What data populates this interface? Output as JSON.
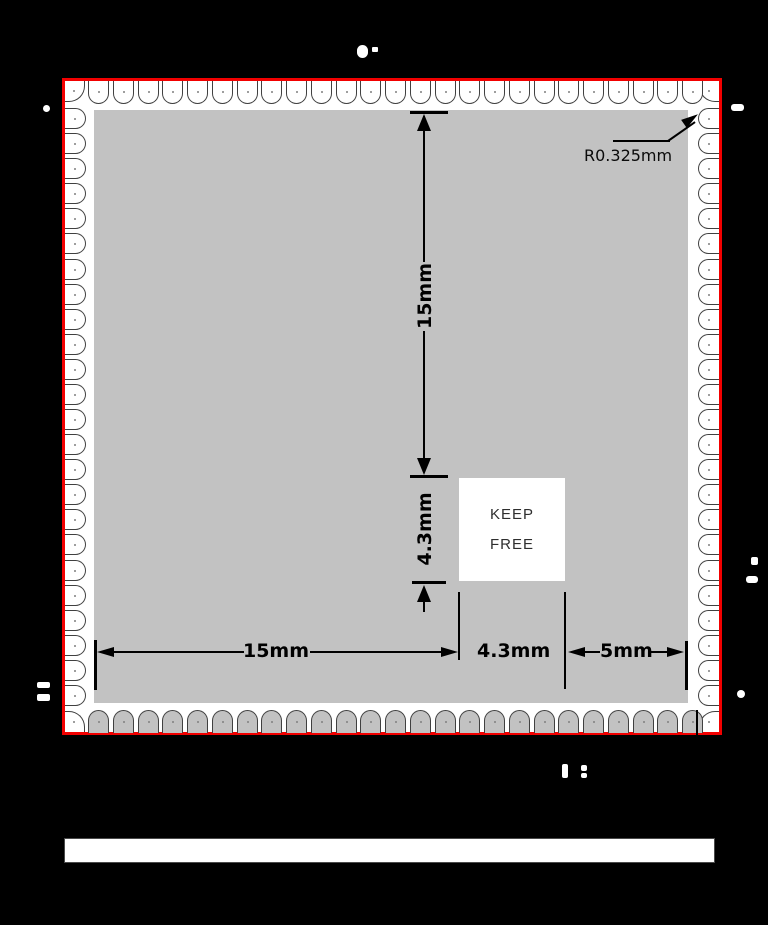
{
  "annotations": {
    "vertical_15mm": "15mm",
    "vertical_4_3mm": "4.3mm",
    "horizontal_15mm": "15mm",
    "horizontal_4_3mm": "4.3mm",
    "horizontal_5mm": "5mm",
    "pad_radius": "R0.325mm",
    "keep_free": {
      "line1": "KEEP",
      "line2": "FREE"
    }
  },
  "colors": {
    "background": "#000000",
    "board_outline": "#f20000",
    "board_fill": "#ffffff",
    "module_fill": "#c2c2c2",
    "pad_outline": "#404040",
    "dimension_lines": "#000000"
  },
  "pads": {
    "top": {
      "count": 25,
      "from": 88,
      "to": 703,
      "size": 21
    },
    "bottom": {
      "count": 25,
      "from": 88,
      "to": 703,
      "size": 21
    },
    "left": {
      "count": 24,
      "from": 108,
      "to": 706,
      "size": 21
    },
    "right": {
      "count": 24,
      "from": 108,
      "to": 706,
      "size": 21
    }
  },
  "artifacts": [
    {
      "x": 357,
      "y": 45,
      "w": 11,
      "h": 13,
      "r": 6
    },
    {
      "x": 372,
      "y": 47,
      "w": 6,
      "h": 5,
      "r": 1
    },
    {
      "x": 43,
      "y": 105,
      "w": 7,
      "h": 7,
      "r": 4
    },
    {
      "x": 731,
      "y": 104,
      "w": 13,
      "h": 7,
      "r": 3
    },
    {
      "x": 751,
      "y": 557,
      "w": 7,
      "h": 8,
      "r": 2
    },
    {
      "x": 746,
      "y": 576,
      "w": 12,
      "h": 7,
      "r": 3
    },
    {
      "x": 737,
      "y": 690,
      "w": 8,
      "h": 8,
      "r": 4
    },
    {
      "x": 37,
      "y": 682,
      "w": 13,
      "h": 6,
      "r": 2
    },
    {
      "x": 37,
      "y": 694,
      "w": 13,
      "h": 7,
      "r": 2
    },
    {
      "x": 562,
      "y": 764,
      "w": 6,
      "h": 14,
      "r": 2
    },
    {
      "x": 581,
      "y": 765,
      "w": 6,
      "h": 6,
      "r": 2
    },
    {
      "x": 581,
      "y": 773,
      "w": 6,
      "h": 5,
      "r": 2
    }
  ]
}
